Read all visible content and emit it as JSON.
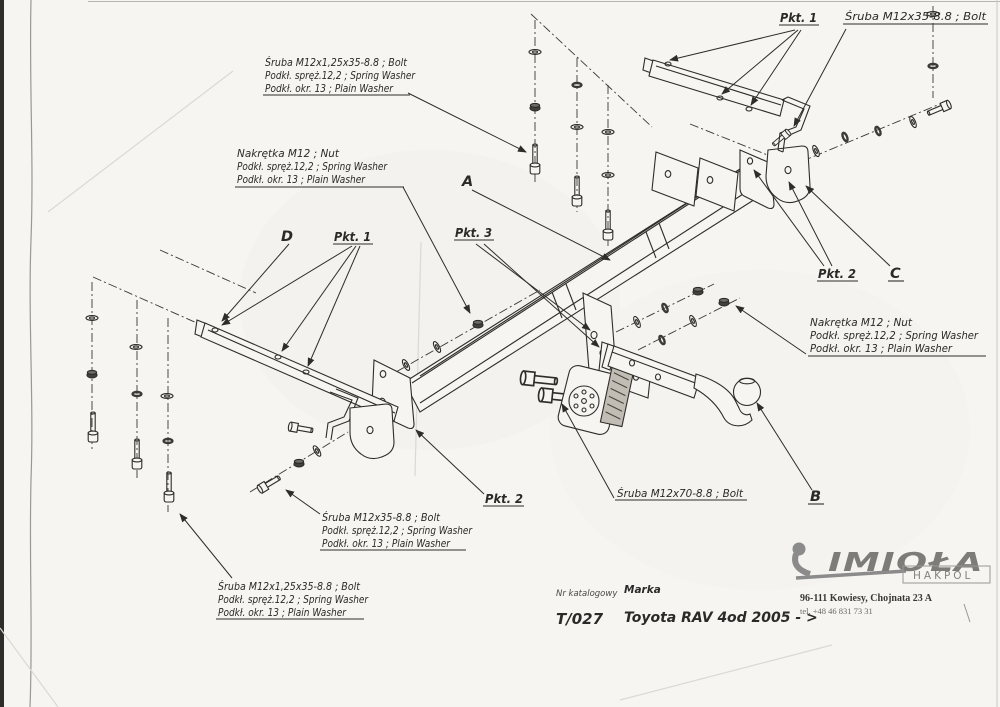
{
  "callouts": {
    "bolt_long_top": {
      "line1": "Śruba M12x1,25x35-8.8 ;  Bolt",
      "line2": "Podkł. spręż.12,2 ; Spring Washer",
      "line3": "Podkł. okr. 13 ; Plain Washer"
    },
    "nut_left": {
      "line1": "Nakrętka  M12 ; Nut",
      "line2": "Podkł. spręż.12,2 ; Spring Washer",
      "line3": "Podkł. okr. 13 ; Plain Washer"
    },
    "nut_right": {
      "line1": "Nakrętka  M12 ; Nut",
      "line2": "Podkł. spręż.12,2 ; Spring Washer",
      "line3": "Podkł. okr. 13 ; Plain Washer"
    },
    "bolt_m35_mid": {
      "line1": "Śruba M12x35-8.8 ;  Bolt",
      "line2": "Podkł. spręż.12,2 ; Spring Washer",
      "line3": "Podkł. okr. 13 ; Plain Washer"
    },
    "bolt_long_bottom": {
      "line1": "Śruba M12x1,25x35-8.8 ;  Bolt",
      "line2": "Podkł. spręż.12,2 ; Spring Washer",
      "line3": "Podkł. okr. 13 ; Plain Washer"
    },
    "bolt_m35_top_right": "Śruba M12x35-8.8 ;  Bolt",
    "bolt_m70": "Śruba M12x70-8.8 ;  Bolt",
    "pkt1_left": "Pkt. 1",
    "pkt1_right": "Pkt. 1",
    "pkt2_center": "Pkt. 2",
    "pkt2_right": "Pkt. 2",
    "pkt3": "Pkt. 3",
    "ref_a": "A",
    "ref_b": "B",
    "ref_c": "C",
    "ref_d": "D"
  },
  "title_block": {
    "catalog_label": "Nr katalogowy",
    "catalog_number": "T/027",
    "brand_label": "Marka",
    "brand_value": "Toyota RAV 4",
    "year_range": "od 2005 - >"
  },
  "manufacturer": {
    "logo_text": "IMIOŁA",
    "logo_sub": "HAKPOL",
    "address": "96-111 Kowiesy, Chojnata 23 A",
    "phone": "tel. +48 46 831 73 31"
  },
  "colors": {
    "ink": "#2f2d2b",
    "paper": "#f6f5f2",
    "logo_gray": "#8b8b8b"
  }
}
